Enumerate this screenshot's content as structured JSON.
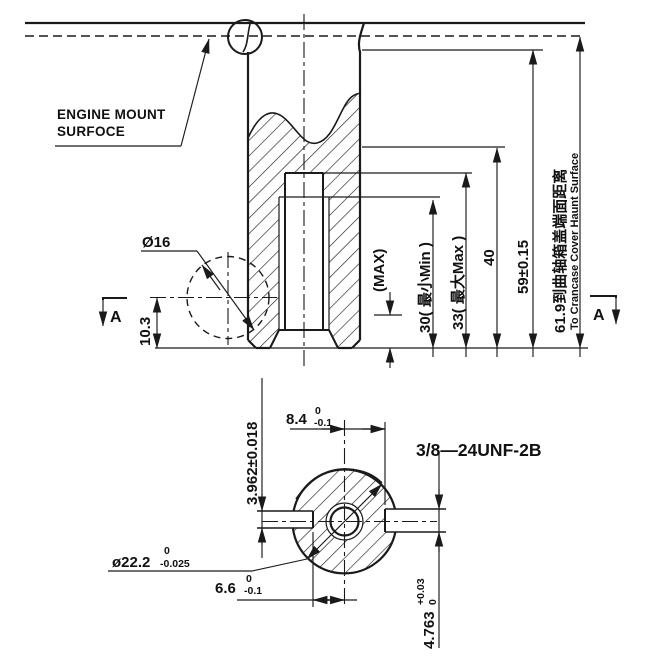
{
  "drawing": {
    "labels": {
      "engine_mount_line1": "ENGINE MOUNT",
      "engine_mount_line2": "SURFOCE",
      "section_marker_left": "A",
      "section_marker_right": "A",
      "thread_callout": "3/8—24UNF-2B"
    },
    "dims": {
      "dia16": "Ø16",
      "d10_3": "10.3",
      "max_note": "(MAX)",
      "d30": "30( 最小Min )",
      "d33": "33( 最大Max )",
      "d40": "40",
      "d59": "59±0.15",
      "d61_9_cn": "61.9到曲轴箱盖端面距离",
      "d61_9_en": "To Crancase Cover Haunt Surface",
      "d3_962": "3.962±0.018",
      "d8_4": {
        "value": "8.4",
        "tol_up": "0",
        "tol_dn": "-0.1"
      },
      "d6_6": {
        "value": "6.6",
        "tol_up": "0",
        "tol_dn": "-0.1"
      },
      "dia22_2": {
        "value": "ø22.2",
        "tol_up": "0",
        "tol_dn": "-0.025"
      },
      "d4_763": {
        "value": "4.763",
        "tol_up": "+0.03",
        "tol_dn": "0"
      }
    },
    "colors": {
      "line": "#1a1a1a",
      "background": "#ffffff"
    }
  }
}
